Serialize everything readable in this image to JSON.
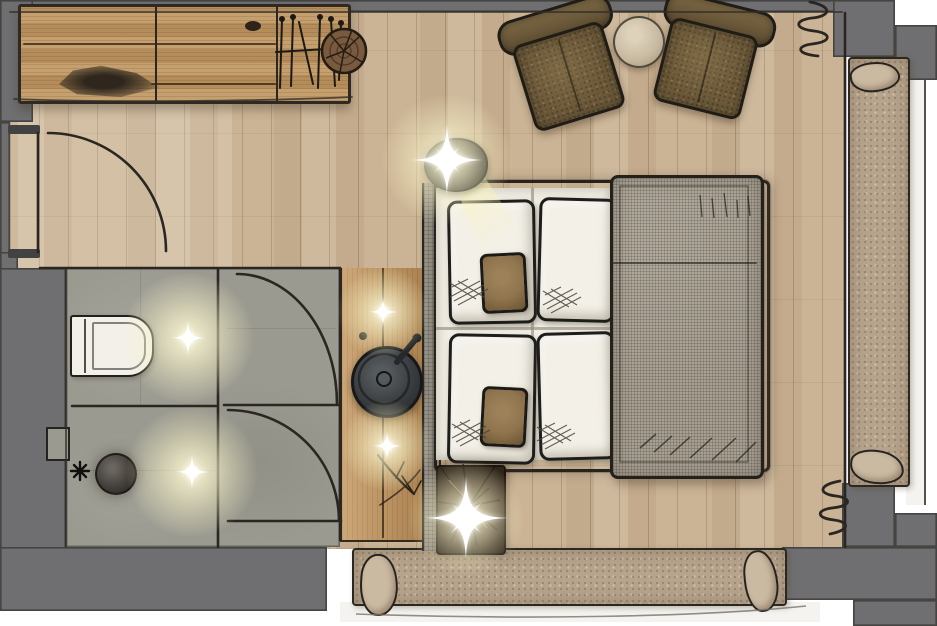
{
  "meta": {
    "kind": "architectural-floor-plan",
    "style": "hand-drawn interior sketch, top-down view",
    "canvas": {
      "width": 937,
      "height": 626
    }
  },
  "palette": {
    "outside": "#ffffff",
    "wall": "#6f6f71",
    "stub": "#434242",
    "line": "#26231f",
    "wood": "#c9b294",
    "stone": "#9b9a90",
    "sideboard": "#bd9560",
    "vanity": "#b98f5c",
    "bedwhite": "#f3f0e7",
    "blanket": "#a79f91",
    "chair": "#6b5939",
    "accent": "#8f744d",
    "fur": "#b7a48c",
    "cushion": "#cbbaa2",
    "tabletop": "#c7b99f",
    "sink": "#3a3d3f",
    "shower": "#44403b",
    "trunk": "#42332a",
    "headboard": "#99948a",
    "balconyfloor": "#f4f3ef",
    "glow": "#fcf8d8"
  },
  "rooms": [
    {
      "id": "bedroom",
      "floor": "oak-planks"
    },
    {
      "id": "entry-hall",
      "floor": "oak-planks"
    },
    {
      "id": "bathroom",
      "floor": "stone-tile"
    },
    {
      "id": "balcony",
      "location": "right-and-bottom",
      "floor": "light"
    }
  ],
  "furniture": [
    {
      "id": "sideboard",
      "room": "entry-hall"
    },
    {
      "id": "wardrobe-rack",
      "room": "entry-hall"
    },
    {
      "id": "log-stool",
      "room": "entry-hall"
    },
    {
      "id": "armchair-left",
      "room": "bedroom"
    },
    {
      "id": "armchair-right",
      "room": "bedroom"
    },
    {
      "id": "side-table",
      "room": "bedroom"
    },
    {
      "id": "double-bed",
      "room": "bedroom",
      "pillows": 4,
      "accent_pillows": 2
    },
    {
      "id": "duvet",
      "room": "bedroom"
    },
    {
      "id": "headboard-panel",
      "room": "bedroom"
    },
    {
      "id": "vanity-counter",
      "room": "bedroom"
    },
    {
      "id": "washbasin",
      "room": "bedroom"
    },
    {
      "id": "branch-decor",
      "room": "bedroom"
    },
    {
      "id": "trunk-slice-mat",
      "room": "bedroom"
    },
    {
      "id": "balcony-bench-right",
      "room": "balcony",
      "cushions": 2
    },
    {
      "id": "balcony-bench-bottom",
      "room": "balcony",
      "cushions": 2
    }
  ],
  "fixtures": [
    {
      "id": "toilet",
      "room": "bathroom"
    },
    {
      "id": "shower",
      "room": "bathroom"
    },
    {
      "id": "shower-valve",
      "room": "bathroom"
    },
    {
      "id": "wall-niche",
      "room": "bathroom"
    },
    {
      "id": "entrance-door",
      "swing": "quarter-arc"
    },
    {
      "id": "bathroom-door-upper",
      "swing": "quarter-arc"
    },
    {
      "id": "bathroom-door-lower",
      "swing": "quarter-arc"
    },
    {
      "id": "window-front",
      "location": "right"
    },
    {
      "id": "curtain-top-right",
      "symbol": "squiggle"
    },
    {
      "id": "curtain-bottom-right",
      "symbol": "squiggle"
    }
  ],
  "lights": [
    {
      "id": "bed-wall-lamp",
      "effect": "sparkle-with-beam"
    },
    {
      "id": "bathroom-light-upper",
      "effect": "sparkle"
    },
    {
      "id": "bathroom-light-lower",
      "effect": "sparkle"
    },
    {
      "id": "vanity-light-upper",
      "effect": "sparkle"
    },
    {
      "id": "vanity-light-lower",
      "effect": "sparkle"
    },
    {
      "id": "floor-spot",
      "effect": "sparkle"
    }
  ]
}
